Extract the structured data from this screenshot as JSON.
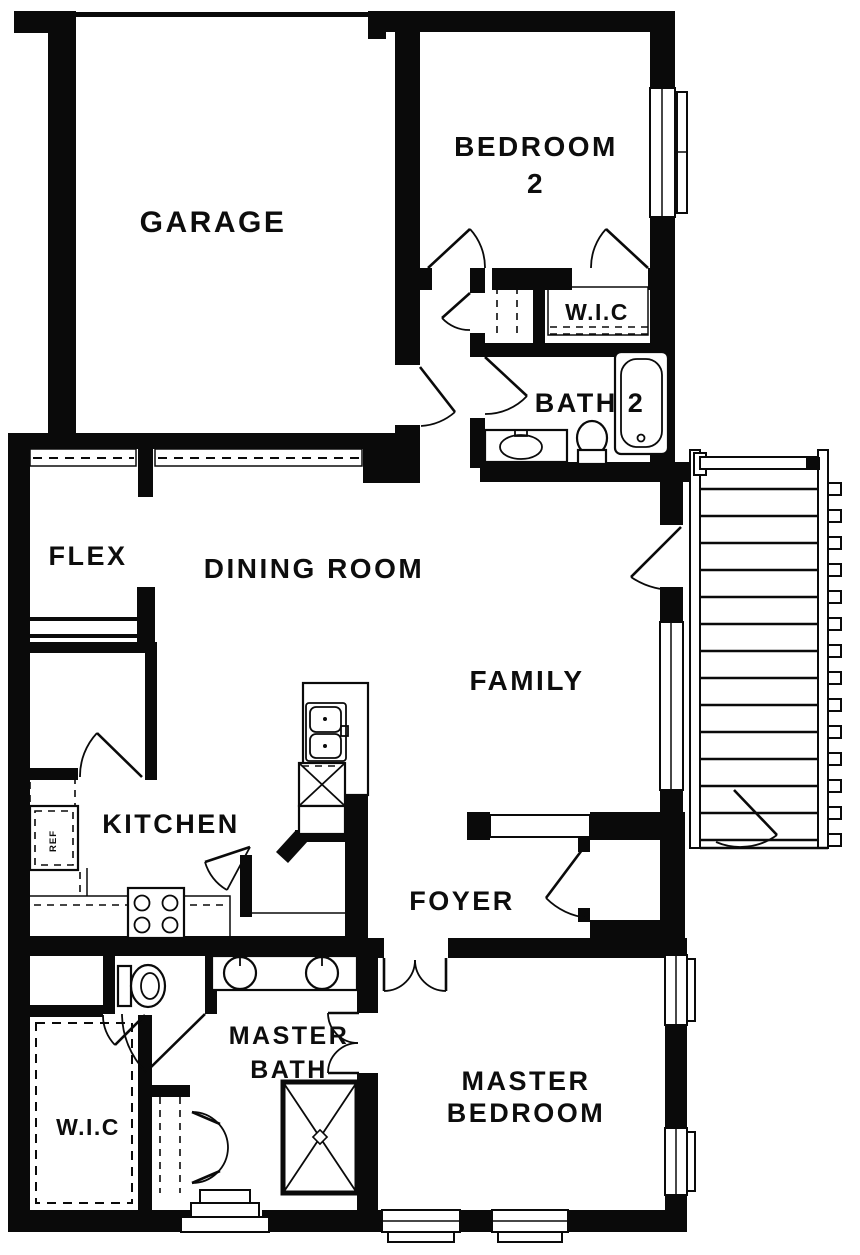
{
  "plan": {
    "type": "single-story house floor plan",
    "colors": {
      "wall": "#0a0a0a",
      "background": "#ffffff"
    },
    "rooms": {
      "garage": {
        "label": "GARAGE"
      },
      "bedroom2": {
        "line1": "BEDROOM",
        "line2": "2"
      },
      "wic_upper": {
        "label": "W.I.C"
      },
      "bath2": {
        "label": "BATH 2"
      },
      "flex": {
        "label": "FLEX"
      },
      "dining": {
        "label": "DINING ROOM"
      },
      "family": {
        "label": "FAMILY"
      },
      "kitchen": {
        "label": "KITCHEN"
      },
      "foyer": {
        "label": "FOYER"
      },
      "master_bath": {
        "line1": "MASTER",
        "line2": "BATH"
      },
      "wic_master": {
        "label": "W.I.C"
      },
      "master_bedroom": {
        "line1": "MASTER",
        "line2": "BEDROOM"
      }
    },
    "fixtures": {
      "refrigerator_label": "REF"
    }
  }
}
